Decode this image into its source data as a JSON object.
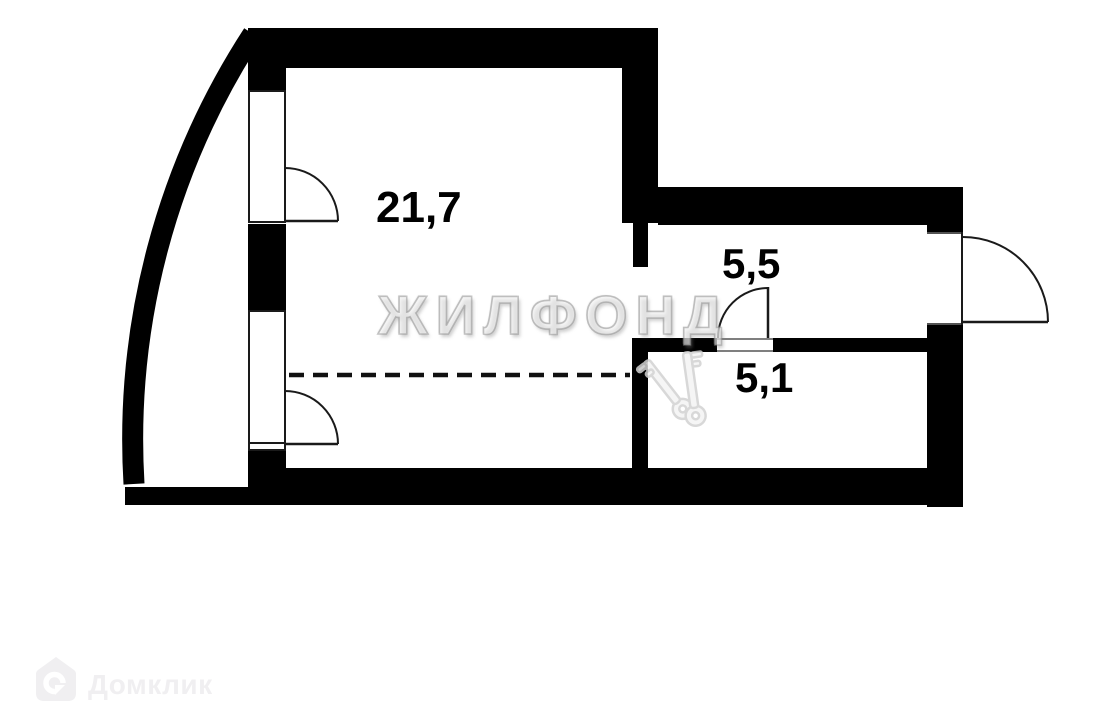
{
  "colors": {
    "background": "#ffffff",
    "walls": "#000000",
    "thin_lines": "#1a1a1a",
    "agency_watermark_gray": "#bdbdbd",
    "portal_logo_gray": "#f0eff1"
  },
  "floorplan": {
    "rooms": [
      {
        "id": "main-room",
        "area_label": "21,7"
      },
      {
        "id": "hallway",
        "area_label": "5,5"
      },
      {
        "id": "bathroom",
        "area_label": "5,1"
      }
    ],
    "features": [
      "curved-outer-balcony-wall",
      "two-balcony-window-doors",
      "dashed-zone-divider",
      "entrance-door-right-wall",
      "bathroom-door-to-hallway"
    ]
  },
  "watermarks": {
    "agency_text": "ЖИЛФОНД",
    "keys_icon": "crossed-keys-icon",
    "portal_logo": {
      "icon": "domclick-house-icon",
      "text": "Домклик"
    }
  }
}
